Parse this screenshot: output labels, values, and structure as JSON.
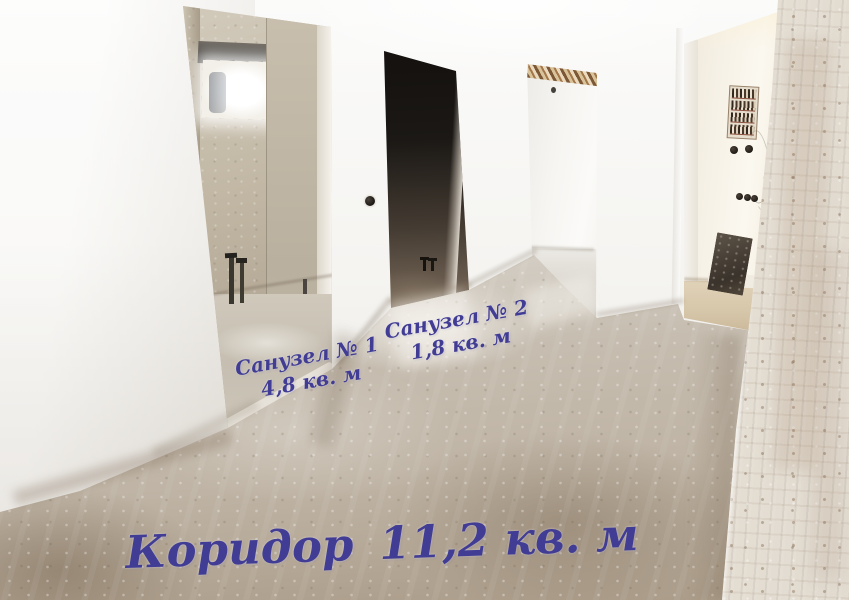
{
  "image": {
    "annotations": {
      "bathroom1": {
        "label": "Санузел № 1",
        "area": "4,8 кв. м"
      },
      "bathroom2": {
        "label": "Санузел № 2",
        "area": "1,8 кв. м"
      },
      "corridor": {
        "label": "Коридор",
        "area": "11,2 кв. м"
      }
    },
    "colors": {
      "annotation-text": "#423d94",
      "wall-white": "#f3f2ef",
      "floor-concrete": "#c6bdb0",
      "plaster-beige": "#c2b8a5",
      "dark-opening": "#1b1815",
      "whitewashed-brick": "#ebe5dc"
    }
  }
}
